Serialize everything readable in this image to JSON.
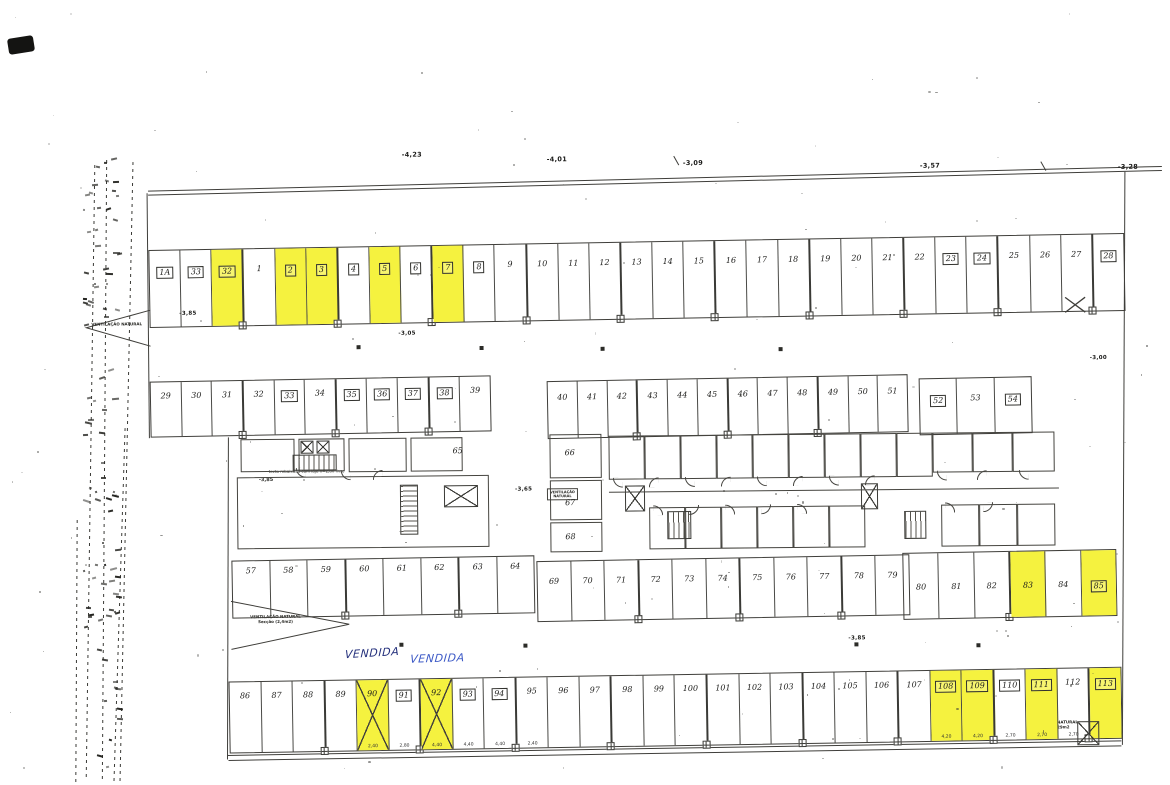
{
  "document_kind": "scanned parking garage floor plan",
  "colors": {
    "highlight": "#f5f23f",
    "ink": "#3f3e3a",
    "pen_dark": "#24307c",
    "pen_blue": "#3c59c6"
  },
  "annotations": {
    "vendida": [
      "VENDIDA",
      "VENDIDA"
    ]
  },
  "elevations": {
    "top": [
      "-4,23",
      "-4,01",
      "-3,09",
      "-3,57",
      "-3,28"
    ],
    "inner": [
      "-3,85",
      "-3,05",
      "-3,65",
      "-3,85",
      "-3,00"
    ]
  },
  "vents": [
    {
      "l1": "VENTILAÇÃO NATURAL",
      "l2": ""
    },
    {
      "l1": "VENTILAÇÃO NATURAL",
      "l2": "Secção (2,4m2)"
    },
    {
      "l1": "VENTILAÇÃO NATURAL",
      "l2": "Secção 0,29m2"
    },
    {
      "l1": "VENTILAÇÃO",
      "l2": "NATURAL"
    }
  ],
  "core": {
    "rooms": [
      "65",
      "66",
      "67",
      "68"
    ],
    "note": "tecto rebaixado com laje h=2,80 livre",
    "note_elev": "-3,85"
  },
  "plan": {
    "rows": [
      {
        "id": "A",
        "stalls": [
          {
            "n": "1A",
            "b": true
          },
          {
            "n": "33",
            "b": true
          },
          {
            "n": "32",
            "b": true,
            "y": true
          },
          {
            "n": "1"
          },
          {
            "n": "2",
            "b": true,
            "y": true
          },
          {
            "n": "3",
            "b": true,
            "y": true
          },
          {
            "n": "4",
            "b": true
          },
          {
            "n": "5",
            "b": true,
            "y": true
          },
          {
            "n": "6",
            "b": true
          },
          {
            "n": "7",
            "b": true,
            "y": true
          },
          {
            "n": "8",
            "b": true
          },
          {
            "n": "9"
          },
          {
            "n": "10"
          },
          {
            "n": "11"
          },
          {
            "n": "12"
          },
          {
            "n": "13"
          },
          {
            "n": "14"
          },
          {
            "n": "15"
          },
          {
            "n": "16"
          },
          {
            "n": "17"
          },
          {
            "n": "18"
          },
          {
            "n": "19"
          },
          {
            "n": "20"
          },
          {
            "n": "21"
          },
          {
            "n": "22"
          },
          {
            "n": "23",
            "b": true
          },
          {
            "n": "24",
            "b": true
          },
          {
            "n": "25"
          },
          {
            "n": "26"
          },
          {
            "n": "27"
          },
          {
            "n": "28",
            "b": true
          }
        ]
      },
      {
        "id": "BL",
        "stalls": [
          {
            "n": "29"
          },
          {
            "n": "30"
          },
          {
            "n": "31"
          },
          {
            "n": "32"
          },
          {
            "n": "33",
            "b": true
          },
          {
            "n": "34"
          },
          {
            "n": "35",
            "b": true
          },
          {
            "n": "36",
            "b": true
          },
          {
            "n": "37",
            "b": true
          },
          {
            "n": "38",
            "b": true
          },
          {
            "n": "39"
          }
        ]
      },
      {
        "id": "BM",
        "stalls": [
          {
            "n": "40"
          },
          {
            "n": "41"
          },
          {
            "n": "42"
          },
          {
            "n": "43"
          },
          {
            "n": "44"
          },
          {
            "n": "45"
          },
          {
            "n": "46"
          },
          {
            "n": "47"
          },
          {
            "n": "48"
          },
          {
            "n": "49"
          },
          {
            "n": "50"
          },
          {
            "n": "51"
          }
        ]
      },
      {
        "id": "BR",
        "stalls": [
          {
            "n": "52",
            "b": true
          },
          {
            "n": "53"
          },
          {
            "n": "54",
            "b": true
          }
        ]
      },
      {
        "id": "CL",
        "stalls": [
          {
            "n": "57"
          },
          {
            "n": "58"
          },
          {
            "n": "59"
          },
          {
            "n": "60"
          },
          {
            "n": "61"
          },
          {
            "n": "62"
          },
          {
            "n": "63"
          },
          {
            "n": "64"
          }
        ]
      },
      {
        "id": "CM",
        "stalls": [
          {
            "n": "69"
          },
          {
            "n": "70"
          },
          {
            "n": "71"
          },
          {
            "n": "72"
          },
          {
            "n": "73"
          },
          {
            "n": "74"
          },
          {
            "n": "75"
          },
          {
            "n": "76"
          },
          {
            "n": "77"
          },
          {
            "n": "78"
          },
          {
            "n": "79"
          }
        ]
      },
      {
        "id": "CR",
        "stalls": [
          {
            "n": "80"
          },
          {
            "n": "81"
          },
          {
            "n": "82"
          },
          {
            "n": "83",
            "y": true
          },
          {
            "n": "84"
          },
          {
            "n": "85",
            "b": true,
            "y": true
          }
        ]
      },
      {
        "id": "D",
        "stalls": [
          {
            "n": "86"
          },
          {
            "n": "87"
          },
          {
            "n": "88"
          },
          {
            "n": "89"
          },
          {
            "n": "90",
            "y": true,
            "x": true,
            "d": "2,40"
          },
          {
            "n": "91",
            "b": true,
            "d": "2,80"
          },
          {
            "n": "92",
            "y": true,
            "x": true,
            "d": "4,40"
          },
          {
            "n": "93",
            "b": true,
            "d": "4,40"
          },
          {
            "n": "94",
            "b": true,
            "d": "4,40"
          },
          {
            "n": "95",
            "d": "2,40"
          },
          {
            "n": "96"
          },
          {
            "n": "97"
          },
          {
            "n": "98"
          },
          {
            "n": "99"
          },
          {
            "n": "100"
          },
          {
            "n": "101"
          },
          {
            "n": "102"
          },
          {
            "n": "103"
          },
          {
            "n": "104"
          },
          {
            "n": "105"
          },
          {
            "n": "106"
          },
          {
            "n": "107"
          },
          {
            "n": "108",
            "b": true,
            "y": true,
            "d": "4,20"
          },
          {
            "n": "109",
            "b": true,
            "y": true,
            "d": "4,20"
          },
          {
            "n": "110",
            "b": true,
            "d": "2,70"
          },
          {
            "n": "111",
            "b": true,
            "y": true,
            "d": "2,70"
          },
          {
            "n": "112",
            "d": "2,70"
          },
          {
            "n": "113",
            "b": true,
            "y": true
          }
        ]
      }
    ]
  }
}
